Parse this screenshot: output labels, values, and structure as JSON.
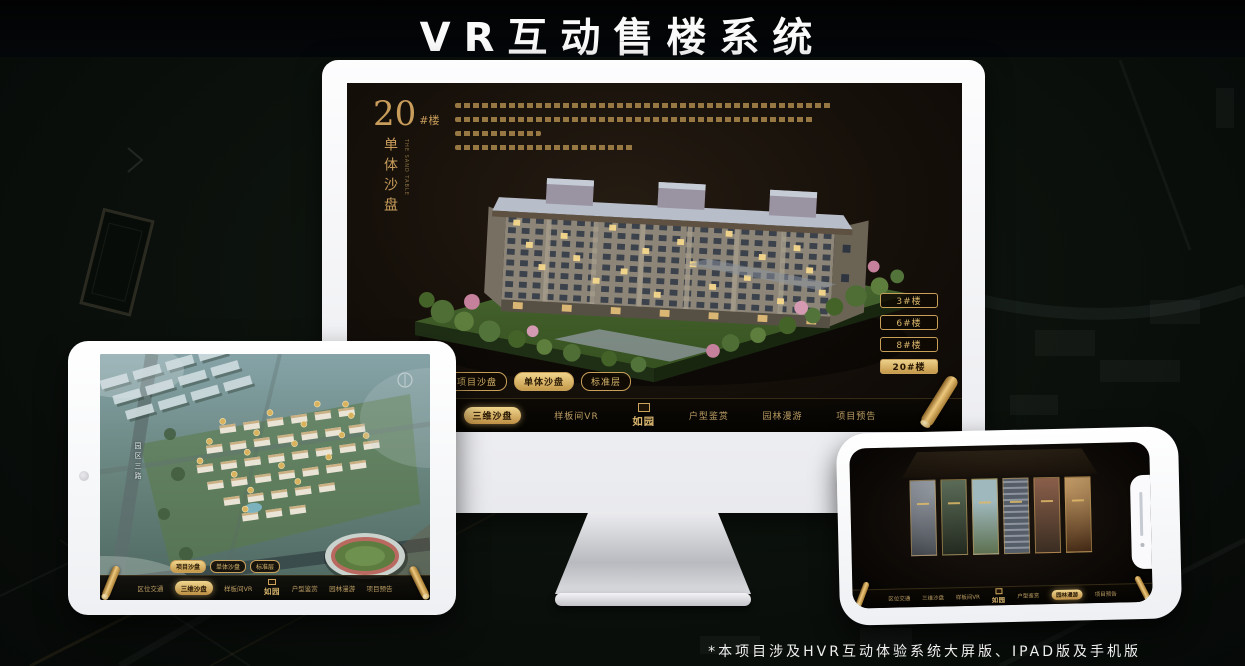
{
  "page": {
    "title": "VR互动售楼系统",
    "footnote": "*本项目涉及HVR互动体验系统大屏版、IPAD版及手机版"
  },
  "logo": {
    "name": "如园"
  },
  "colors": {
    "gold": "#d2a95f",
    "gold_dark": "#8a6326",
    "screen_bg": "#17100a",
    "background": "#0b100c"
  },
  "monitor": {
    "heading": {
      "number": "20",
      "unit": "#楼",
      "title_vertical": "单体沙盘",
      "subtitle_en": "THE SAND TABLE"
    },
    "floor_buttons": [
      "3#楼",
      "6#楼",
      "8#楼",
      "20#楼"
    ],
    "active_floor": "20#楼",
    "tabs": [
      "项目沙盘",
      "单体沙盘",
      "标准层"
    ],
    "active_tab": "单体沙盘",
    "nav": [
      "区位交通",
      "三维沙盘",
      "样板间VR",
      "户型鉴赏",
      "园林漫游",
      "项目预告"
    ],
    "active_nav": "三维沙盘"
  },
  "tablet": {
    "tabs": [
      "项目沙盘",
      "单体沙盘",
      "标准层"
    ],
    "active_tab": "项目沙盘",
    "nav": [
      "区位交通",
      "三维沙盘",
      "样板间VR",
      "户型鉴赏",
      "园林漫游",
      "项目预告"
    ],
    "active_nav": "三维沙盘",
    "map_road_label": "园区三路"
  },
  "phone": {
    "nav": [
      "区位交通",
      "三维沙盘",
      "样板间VR",
      "户型鉴赏",
      "园林漫游",
      "项目预告"
    ],
    "active_nav": "园林漫游"
  }
}
